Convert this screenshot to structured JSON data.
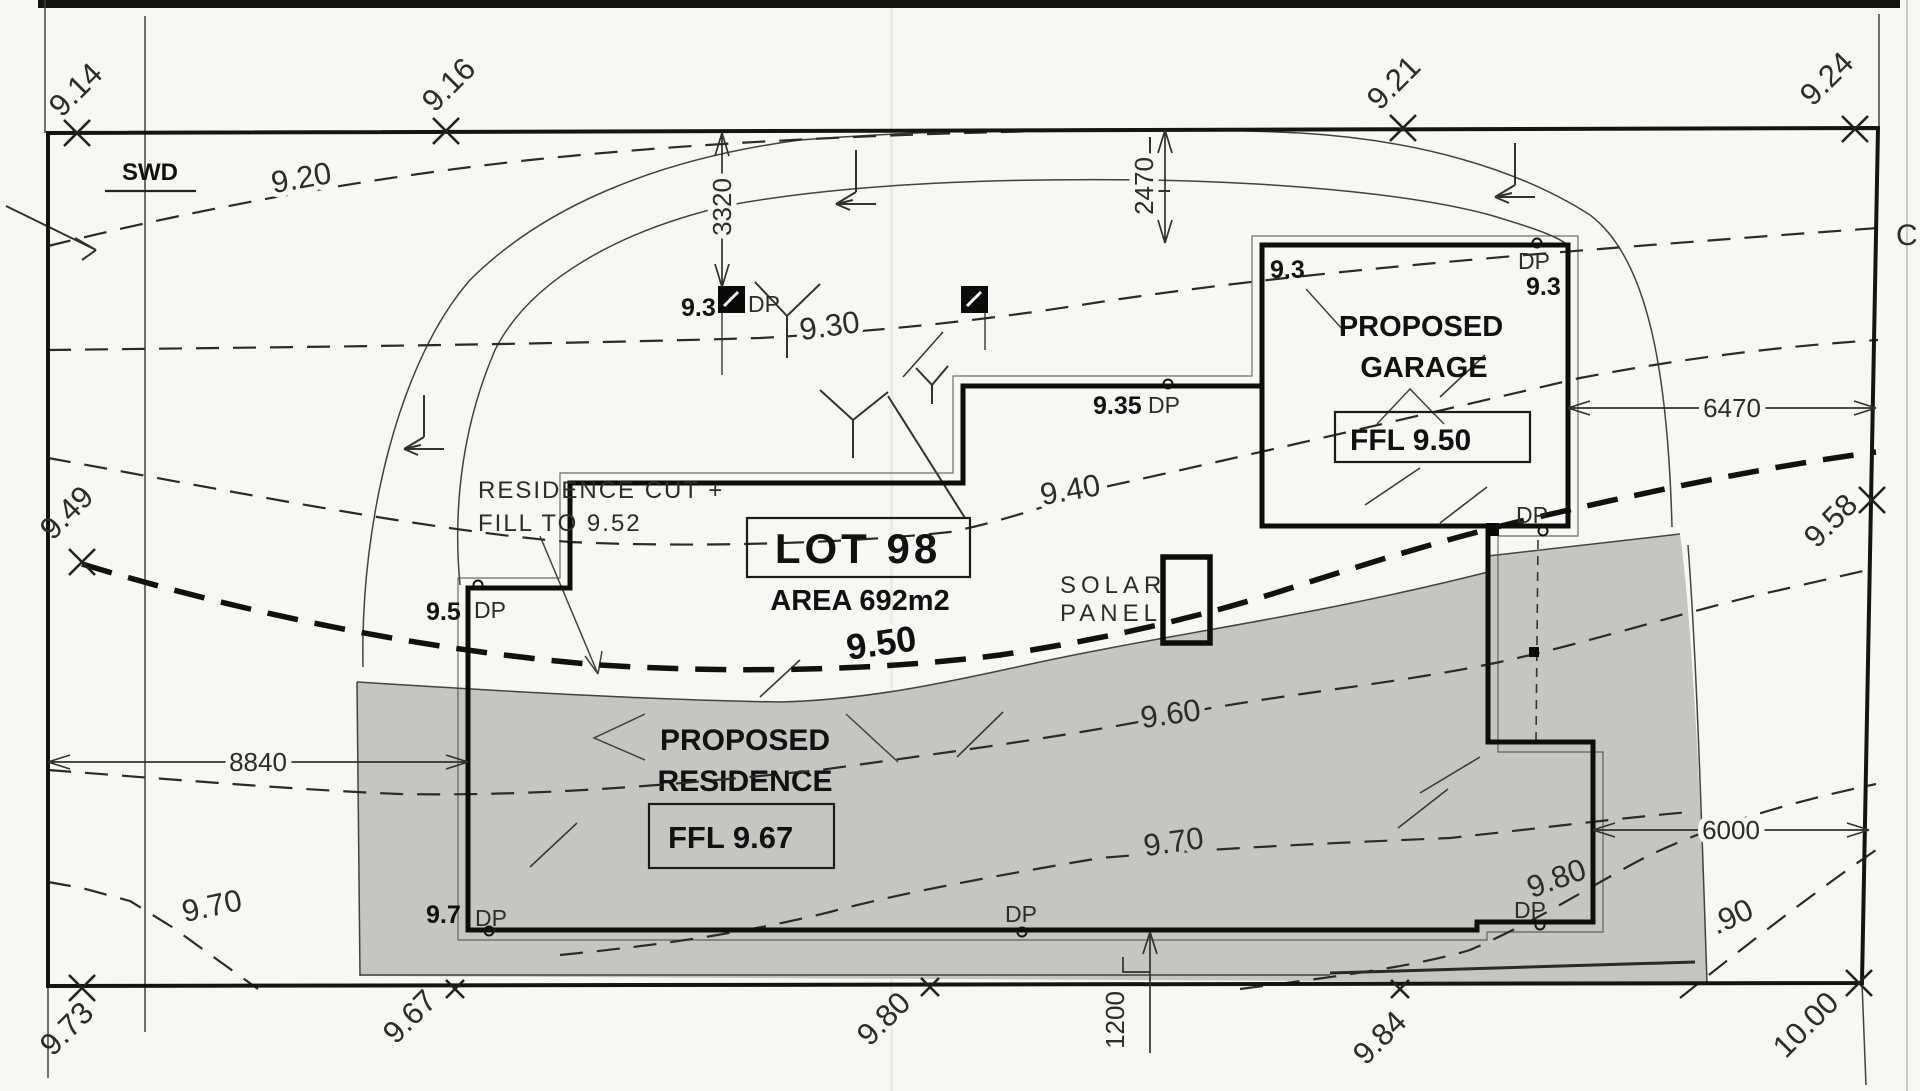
{
  "page": {
    "edge_text": "C"
  },
  "swd": {
    "label": "SWD"
  },
  "lot": {
    "title": "LOT  98",
    "area": "AREA 692m2"
  },
  "residence": {
    "line1": "PROPOSED",
    "line2": "RESIDENCE",
    "ffl": "FFL 9.67",
    "cut_line1": "RESIDENCE CUT +",
    "cut_line2": "FILL TO 9.52"
  },
  "garage": {
    "line1": "PROPOSED",
    "line2": "GARAGE",
    "ffl": "FFL 9.50"
  },
  "solar": {
    "line1": "SOLAR",
    "line2": "PANEL"
  },
  "downpipe_label": "DP",
  "levels": {
    "pit1": "9.3",
    "wall_mid": "9.35",
    "garage_nw": "9.3",
    "garage_ne": "9.3",
    "res_nw": "9.5",
    "res_sw": "9.7"
  },
  "contours": {
    "c920": "9.20",
    "c930": "9.30",
    "c940": "9.40",
    "c950": "9.50",
    "c960": "9.60",
    "c970": "9.70",
    "c970_street": "9.70",
    "c980": "9.80",
    "c990": ".90"
  },
  "spot_levels": {
    "s914": "9.14",
    "s916": "9.16",
    "s921": "9.21",
    "s924": "9.24",
    "s949": "9.49",
    "s958": "9.58",
    "s973": "9.73",
    "s967": "9.67",
    "s980": "9.80",
    "s984": "9.84",
    "s1000": "10.00"
  },
  "dimensions": {
    "d3320": "3320",
    "d2470": "2470",
    "d6470": "6470",
    "d8840": "8840",
    "d6000": "6000",
    "d1200": "1200"
  }
}
